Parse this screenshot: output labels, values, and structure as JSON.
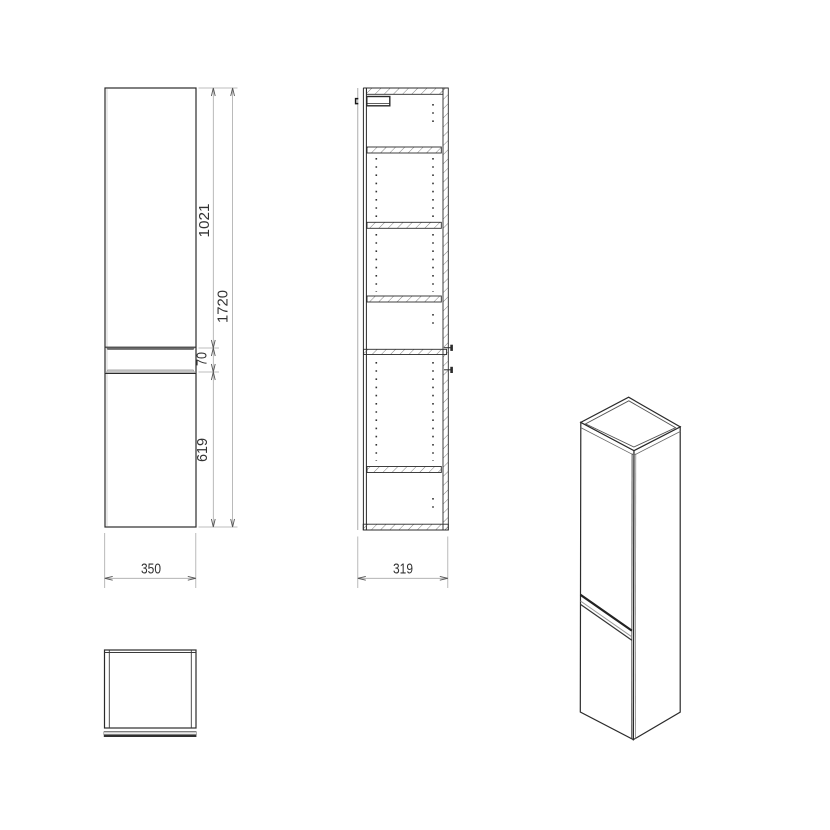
{
  "title": "tall-cabinet-technical-drawing",
  "dimensions": {
    "front": {
      "upper_height": "1021",
      "total_height": "1720",
      "gap": "70",
      "lower_height": "619",
      "width": "350"
    },
    "section": {
      "depth": "319"
    }
  },
  "colors": {
    "background": "#ffffff",
    "line": "#2b2b2b",
    "dim_line": "#a8a8a8",
    "dim_text": "#333333",
    "hatch": "#555555",
    "handle_dark": "#6a6a6a",
    "handle_light": "#c4c4c4"
  }
}
